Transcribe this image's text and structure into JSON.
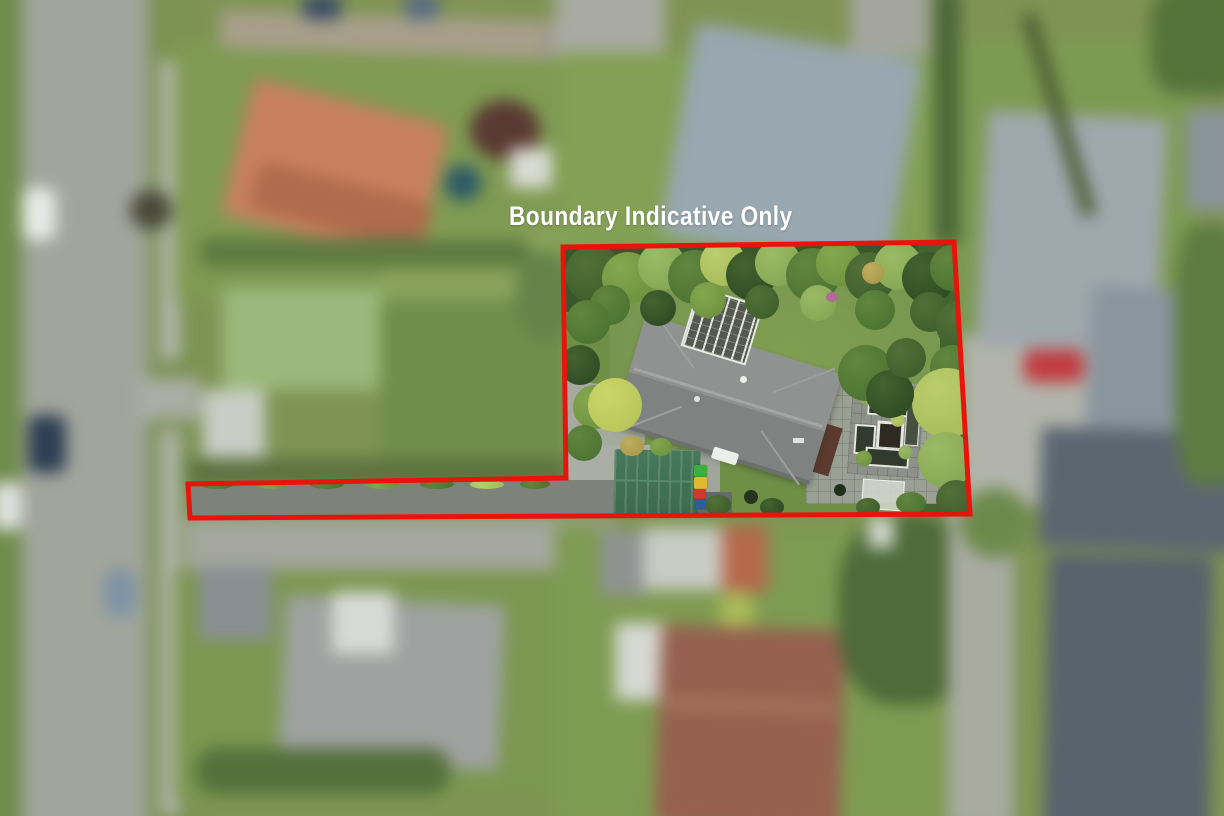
{
  "overlay": {
    "label": "Boundary Indicative Only",
    "text_color": "#ffffff"
  },
  "boundary": {
    "color": "#e8140c",
    "stroke_width": 5,
    "points": "563,247 954,242 970,514 190,518 188,484 566,478"
  },
  "palette": {
    "bin_colors": {
      "green": "#3fae3f",
      "yellow": "#dfb92f",
      "red": "#cf3a2c",
      "blue": "#2d5ca1"
    },
    "main_house_roof": "#8a8c8b",
    "garden_shed_roof": "#417253",
    "neighbour_terracotta_roof": "#c8805f",
    "red_car": "#c23a3f",
    "road": "#a2a59c",
    "lawn": "#7f9a52"
  }
}
